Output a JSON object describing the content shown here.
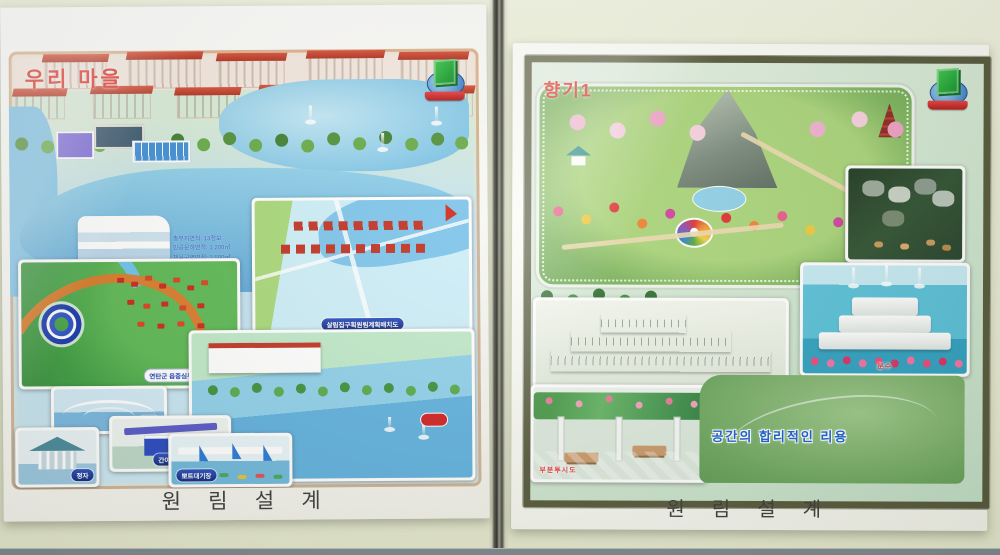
{
  "left_poster": {
    "title": "우리 마을",
    "footer": "원 림 설 계",
    "stats_lines": [
      "총부지면적: 13정보",
      "인공운하면적: 1 200㎡",
      "체육구역면적: 1 500㎡"
    ],
    "plan_inset_caption": "살림집구획원림계획배치도",
    "town_inset_caption": "연탄군 읍중심부 세부계획도",
    "small_insets": [
      {
        "label": "다리"
      },
      {
        "label": "정자"
      },
      {
        "label": "간이매대"
      },
      {
        "label": "뽀트대기장"
      }
    ],
    "emblem_icon": "green-cube-globe-red-ribbon-emblem"
  },
  "right_poster": {
    "title": "향기1",
    "footer": "원 림 설 계",
    "slogan": "공간의 합리적인 리용",
    "fountain_caption": "분수",
    "pergola_caption": "부분투시도",
    "emblem_icon": "green-cube-globe-red-ribbon-emblem"
  },
  "colors": {
    "wall": "#e9ecd3",
    "divider": "#4a4a42",
    "title_red": "#e03228",
    "caption_pill_blue": "#16328f",
    "slogan_blue": "#1560d0",
    "right_frame_olive": "#55583a",
    "footer_text": "#3b3b3b"
  }
}
